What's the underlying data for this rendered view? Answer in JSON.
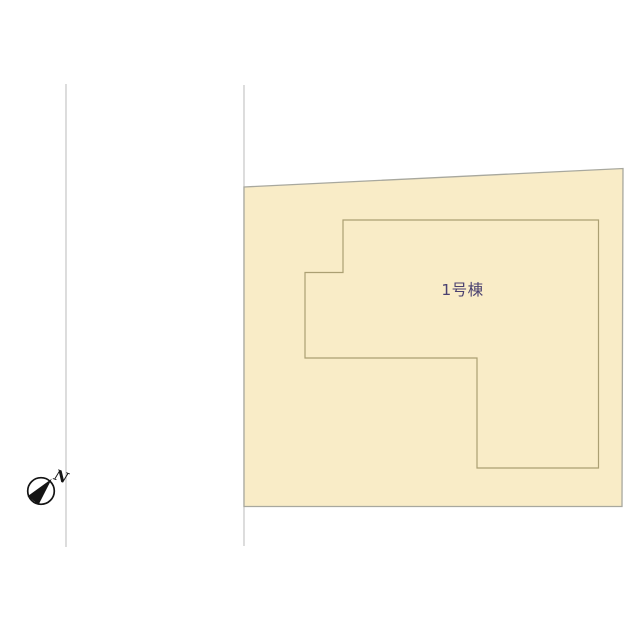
{
  "diagram": {
    "type": "real-estate site plan",
    "building_label": "1号棟",
    "compass_north_label": "N",
    "colors": {
      "background": "#ffffff",
      "lot_fill": "#f9ecc7",
      "lot_stroke": "#a8a89e",
      "building_stroke": "#ab9f73",
      "road_line": "#c6c6c6",
      "label_text": "#4a4170",
      "compass_line": "#141414",
      "compass_needle": "#141414",
      "compass_face": "#ffffff"
    }
  }
}
